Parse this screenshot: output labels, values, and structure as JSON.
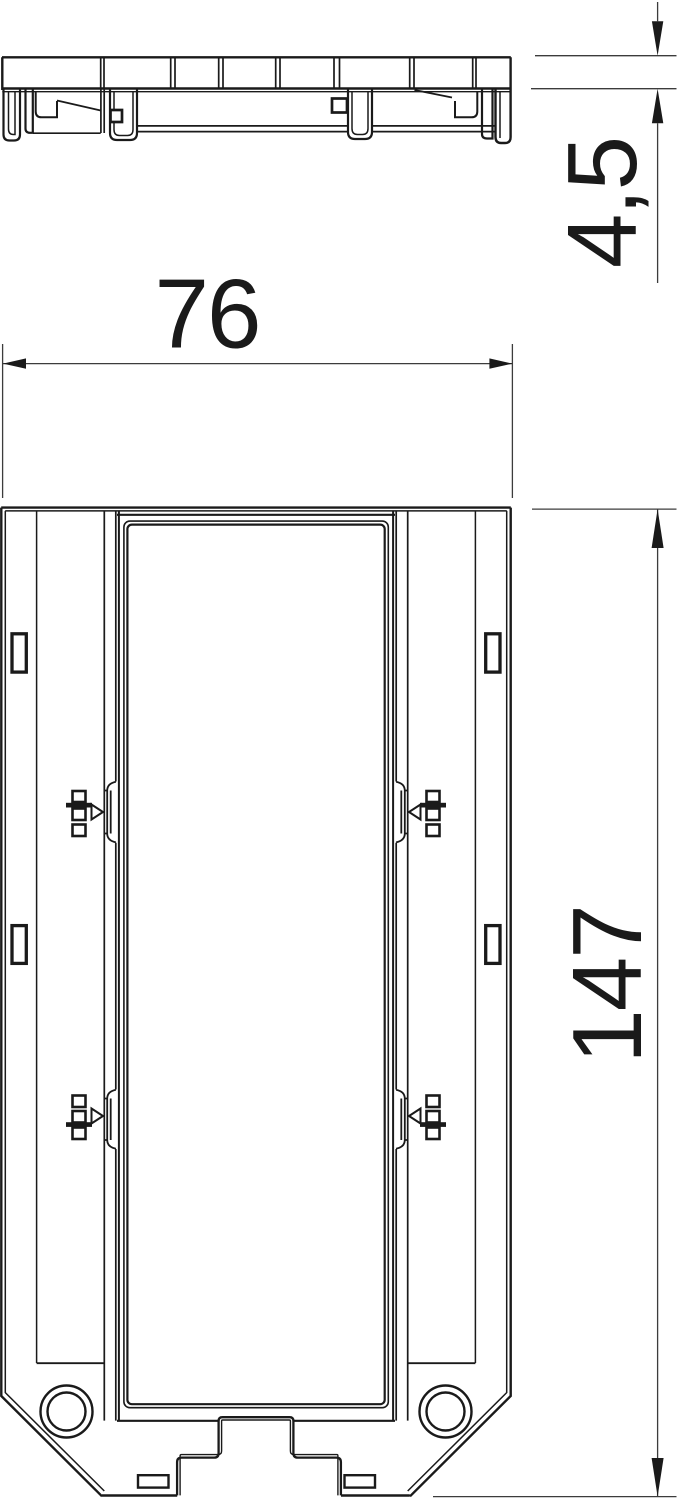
{
  "drawing": {
    "kind": "technical-dimension-drawing",
    "background_color": "#ffffff",
    "line_color": "#1a1a1a",
    "dimension_line_color": "#3c3c3c",
    "views": {
      "side_view": "profile view of mounting frame with snap feet",
      "front_view": "plan view of mounting frame with central opening, latches and fixing holes"
    },
    "dimensions": {
      "width": {
        "label": "76",
        "orientation": "horizontal"
      },
      "thickness": {
        "label": "4,5",
        "orientation": "vertical"
      },
      "height": {
        "label": "147",
        "orientation": "vertical"
      }
    }
  }
}
